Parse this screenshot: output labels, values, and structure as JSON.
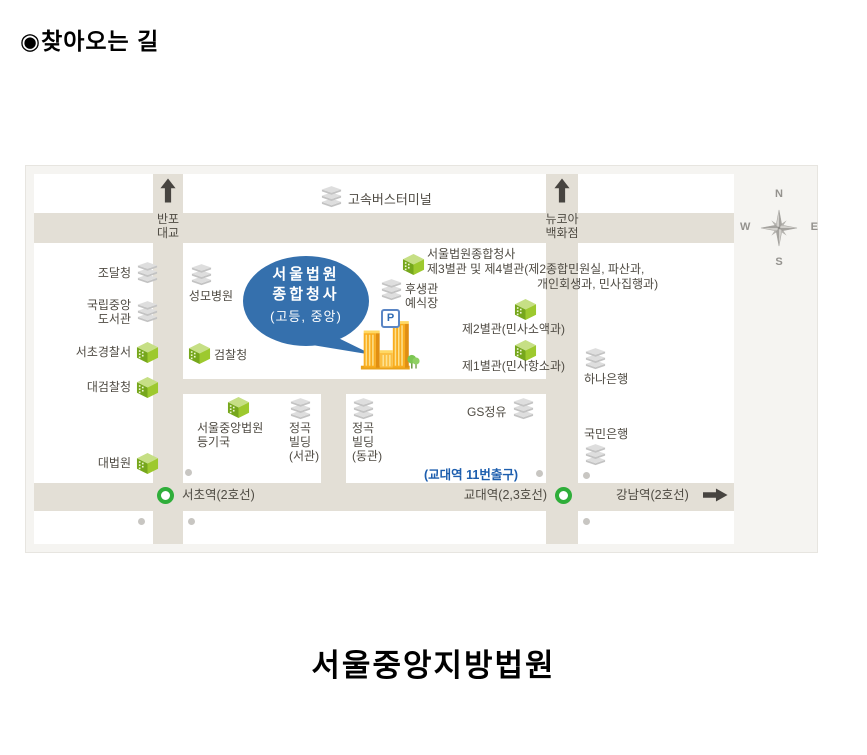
{
  "page": {
    "bullet": "◉",
    "title": "찾아오는 길",
    "footer_title": "서울중앙지방법원"
  },
  "compass": {
    "n": "N",
    "e": "E",
    "s": "S",
    "w": "W"
  },
  "roads": {
    "banpo_bridge": [
      "반포",
      "대교"
    ],
    "newcore_dept": [
      "뉴코아",
      "백화점"
    ],
    "bus_terminal": "고속버스터미널"
  },
  "left_column": [
    {
      "lines": [
        "조달청"
      ]
    },
    {
      "lines": [
        "국립중앙",
        "도서관"
      ]
    },
    {
      "lines": [
        "서초경찰서"
      ]
    },
    {
      "lines": [
        "대검찰청"
      ]
    },
    {
      "lines": [
        "대법원"
      ]
    }
  ],
  "center_block": {
    "hospital": "성모병원",
    "balloon": {
      "line1": "서울법원",
      "line2": "종합청사",
      "sub": "(고등, 중앙)"
    },
    "prosecutors": "검찰청",
    "parking": "P",
    "welfare": [
      "후생관",
      "예식장"
    ],
    "annex34": {
      "line1": "서울법원종합청사",
      "line2": "제3별관 및 제4별관(제2종합민원실, 파산과,",
      "line3": "개인회생과, 민사집행과)"
    },
    "annex2": "제2별관(민사소액과)",
    "annex1": "제1별관(민사항소과)"
  },
  "right_column": {
    "hana": "하나은행",
    "kookmin": "국민은행"
  },
  "lower_blocks": {
    "registry": [
      "서울중앙법원",
      "등기국"
    ],
    "jeonggok_west": [
      "정곡",
      "빌딩",
      "(서관)"
    ],
    "jeonggok_east": [
      "정곡",
      "빌딩",
      "(동관)"
    ],
    "gs_oil": "GS정유",
    "gyodae_exit": "(교대역 11번출구)"
  },
  "stations": {
    "seocho": "서초역(2호선)",
    "gyodae": "교대역(2,3호선)",
    "gangnam": "강남역(2호선)"
  },
  "colors": {
    "balloon_blue": "#3570ad",
    "road_beige": "#e3dfd6",
    "subway_green": "#2fae3a",
    "link_blue": "#1d5eae",
    "building_orange": "#f9ad1e",
    "icon_green": "#9dc92e",
    "icon_gray": "#dedede"
  }
}
